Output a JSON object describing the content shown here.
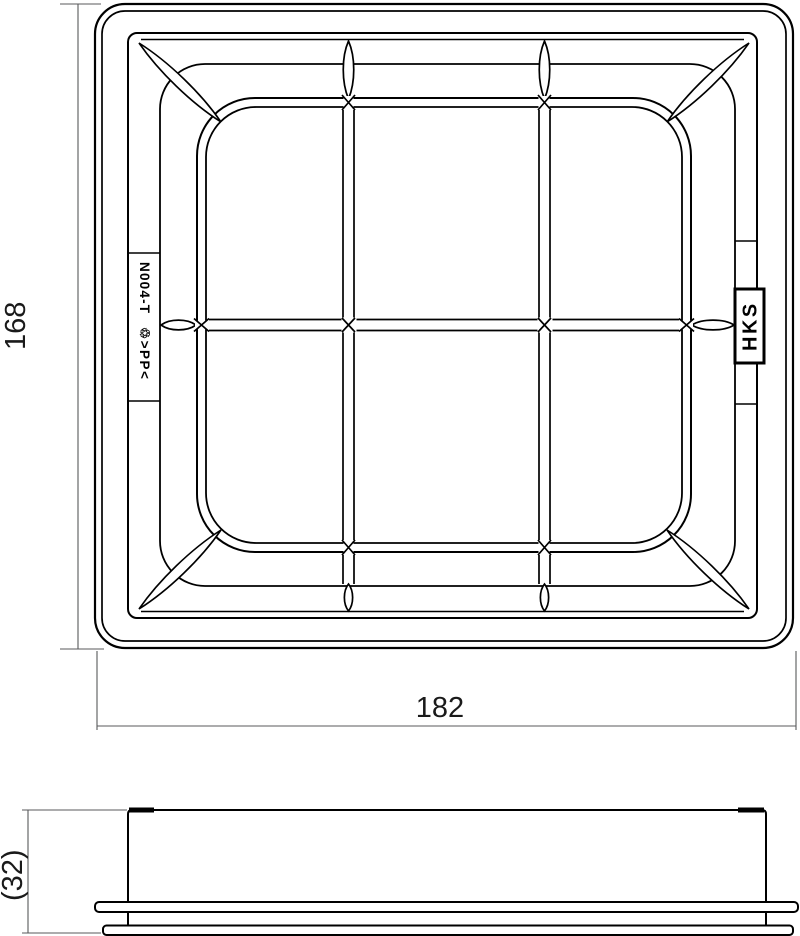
{
  "drawing": {
    "plan_view": {
      "part_number": "N004-T",
      "material_mark": "♲>PP<",
      "brand_logo": "HKS",
      "dim_width": "182",
      "dim_height": "168"
    },
    "side_view": {
      "dim_depth": "(32)"
    },
    "colors": {
      "line": "#000000",
      "dim_line": "#58595b",
      "text": "#1a1a1a",
      "background": "#ffffff"
    }
  }
}
